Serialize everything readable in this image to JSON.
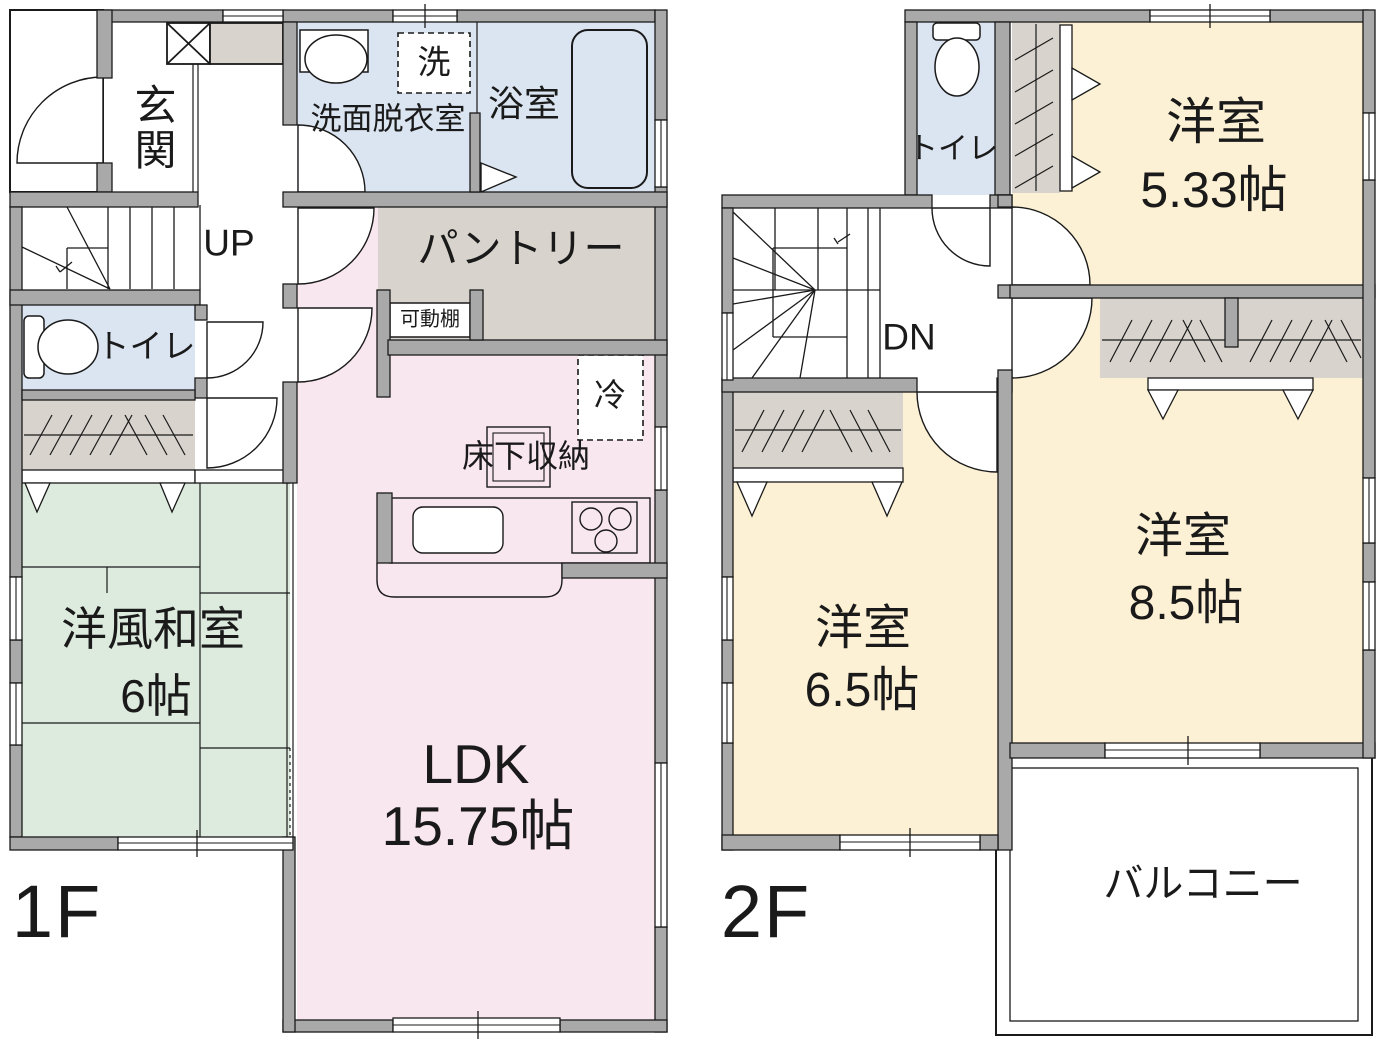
{
  "colors": {
    "wall": "#a9a9a9",
    "outline": "#1a1a1a",
    "wet_room": "#dbe5f1",
    "ldk": "#f9e7ef",
    "tatami_room": "#ddebde",
    "western_room": "#fcf1d4",
    "storage": "#d8d4cd",
    "background": "#ffffff"
  },
  "floors": [
    {
      "label": "1F",
      "rooms": [
        {
          "name": "entrance",
          "label": "玄関"
        },
        {
          "name": "washroom",
          "label": "洗面脱衣室"
        },
        {
          "name": "bathroom",
          "label": "浴室"
        },
        {
          "name": "toilet",
          "label": "トイレ"
        },
        {
          "name": "pantry",
          "label": "パントリー"
        },
        {
          "name": "ldk",
          "label": "LDK",
          "size": "15.75帖"
        },
        {
          "name": "japanese-room",
          "label": "洋風和室",
          "size": "6帖"
        }
      ],
      "annotations": [
        {
          "name": "stairs-up",
          "label": "UP"
        },
        {
          "name": "washing-machine",
          "label": "洗"
        },
        {
          "name": "refrigerator",
          "label": "冷"
        },
        {
          "name": "movable-shelf",
          "label": "可動棚"
        },
        {
          "name": "underfloor-storage",
          "label": "床下収納"
        }
      ]
    },
    {
      "label": "2F",
      "rooms": [
        {
          "name": "toilet",
          "label": "トイレ"
        },
        {
          "name": "western-room-5-33",
          "label": "洋室",
          "size": "5.33帖"
        },
        {
          "name": "western-room-8-5",
          "label": "洋室",
          "size": "8.5帖"
        },
        {
          "name": "western-room-6-5",
          "label": "洋室",
          "size": "6.5帖"
        },
        {
          "name": "balcony",
          "label": "バルコニー"
        }
      ],
      "annotations": [
        {
          "name": "stairs-down",
          "label": "DN"
        }
      ]
    }
  ]
}
